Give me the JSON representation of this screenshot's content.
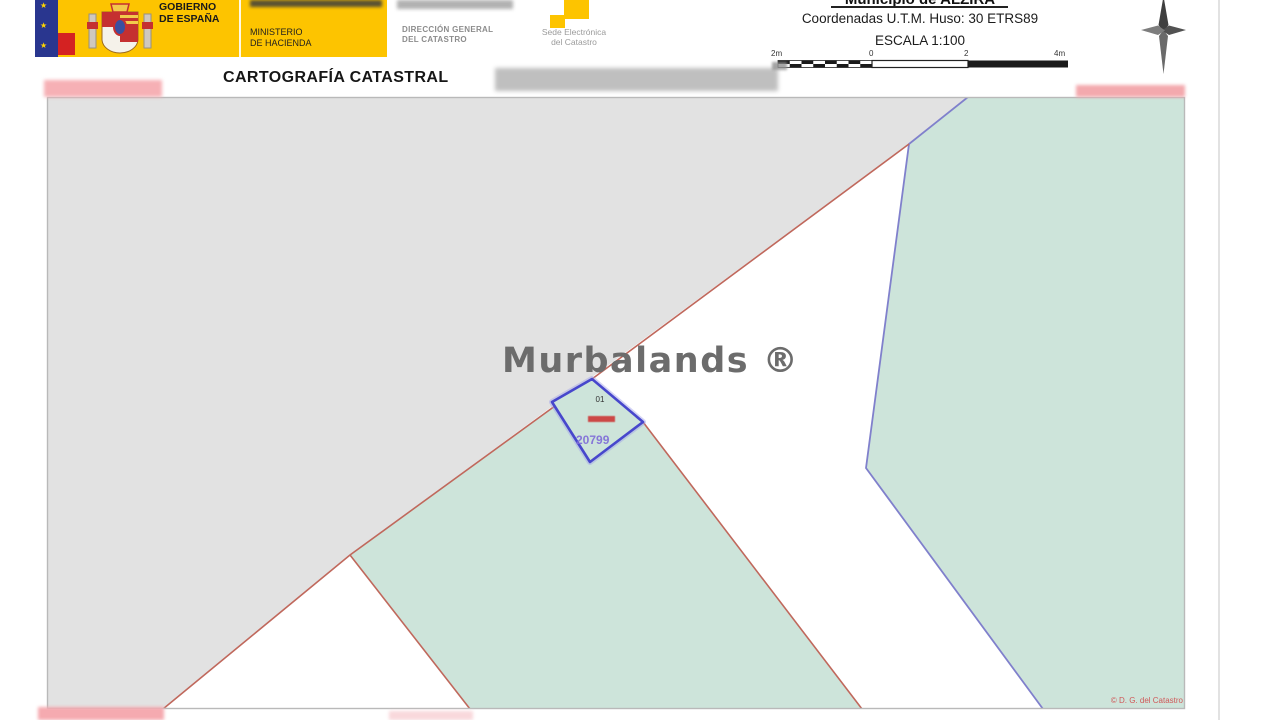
{
  "header": {
    "government": {
      "line1": "GOBIERNO",
      "line2": "DE ESPAÑA"
    },
    "ministry": {
      "line1": "MINISTERIO",
      "line2": "DE HACIENDA"
    },
    "direccion": {
      "line1": "DIRECCIÓN GENERAL",
      "line2": "DEL CATASTRO"
    },
    "sede": {
      "line1": "Sede Electrónica",
      "line2": "del Catastro"
    },
    "title": "CARTOGRAFÍA CATASTRAL",
    "municipality": "Municipio de ALZIRA",
    "coordinates": "Coordenadas U.T.M. Huso: 30 ETRS89",
    "scale_text": "ESCALA 1:100",
    "scalebar": {
      "labels": [
        "2m",
        "0",
        "2",
        "4m"
      ]
    }
  },
  "map": {
    "subparcel_label": "01",
    "parcel_number": "20799",
    "copyright": "© D. G. del Catastro",
    "watermark": "Murbalands ®"
  },
  "icons": {
    "compass": "compass-rose-icon",
    "emblem": "spain-coat-of-arms",
    "flag": "eu-spain-flag"
  },
  "colors": {
    "banner_yellow": "#fdc400",
    "region_gray": "#e2e2e2",
    "parcel_green": "#cde4da",
    "boundary_red": "#c0685c",
    "boundary_blue": "#8080cc",
    "parcel_outline_blue": "#4747cc",
    "parcel_number_purple": "#7e6bd8",
    "copyright_red": "#d05858"
  }
}
